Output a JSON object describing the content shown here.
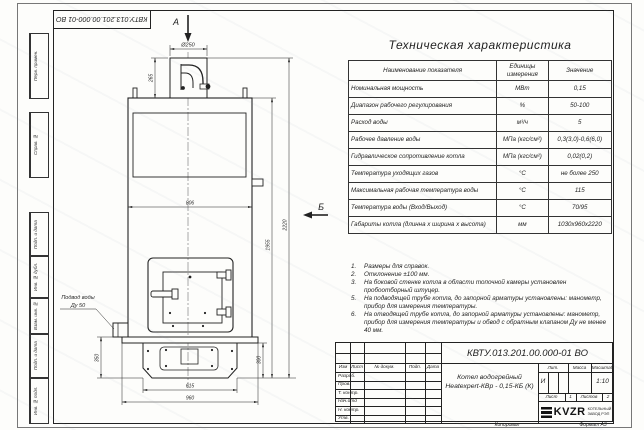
{
  "sheet": {
    "doc_number": "КВТУ.013.201.00.000-01 ВО",
    "copied_label": "Копировал",
    "format_label": "Формат А3",
    "margin_labels": [
      "Перв. примен.",
      "Справ. №",
      "Подп. и дата",
      "Инв. № дубл.",
      "Взам. инв. №",
      "Подп. и дата",
      "Инв. № подл."
    ]
  },
  "spec_table": {
    "title": "Техническая характеристика",
    "headers": [
      "Наименование показателя",
      "Единицы измерения",
      "Значение"
    ],
    "rows": [
      {
        "name": "Номинальная мощность",
        "unit": "МВт",
        "value": "0,15"
      },
      {
        "name": "Диапазон рабочего регулирования",
        "unit": "%",
        "value": "50-100"
      },
      {
        "name": "Расход воды",
        "unit": "м³/ч",
        "value": "5"
      },
      {
        "name": "Рабочее давление воды",
        "unit": "МПа (кгс/см²)",
        "value": "0,3(3,0)-0,6(6,0)"
      },
      {
        "name": "Гидравлическое сопротивление котла",
        "unit": "МПа (кгс/см²)",
        "value": "0,02(0,2)"
      },
      {
        "name": "Температура уходящих газов",
        "unit": "°С",
        "value": "не более 250"
      },
      {
        "name": "Максимальная рабочая температура воды",
        "unit": "°С",
        "value": "115"
      },
      {
        "name": "Температура воды (Вход/Выход)",
        "unit": "°С",
        "value": "70/95"
      },
      {
        "name": "Габариты котла (длинна х ширина х высота)",
        "unit": "мм",
        "value": "1030х960х2220"
      }
    ]
  },
  "notes": [
    {
      "num": "1.",
      "text": "Размеры для справок."
    },
    {
      "num": "2.",
      "text": "Отклонение ±100 мм."
    },
    {
      "num": "3.",
      "text": "На боковой стенке котла в области топочной камеры установлен пробоотборный штуцер."
    },
    {
      "num": "5.",
      "text": "На подводящей трубе котла, до запорной арматуры установлены: манометр, прибор для измерения температуры."
    },
    {
      "num": "6.",
      "text": "На отводящей трубе котла, до запорной арматуры установлены: манометр, прибор для измерения температуры и обвод с обратным клапаном Ду не менее 40 мм."
    }
  ],
  "title_block": {
    "columns": [
      "Изм",
      "Лист",
      "№ докум.",
      "Подп.",
      "Дата"
    ],
    "sign_rows": [
      "Разраб.",
      "Пров.",
      "Т. контр.",
      "Нач.отд",
      "Н. контр.",
      "Утв."
    ],
    "product_line1": "Котел водогрейный",
    "product_line2": "Heatexpert-КВр - 0,15-КБ (К)",
    "lit_header": "Лит.",
    "lit_value": "И",
    "mass_header": "Масса",
    "scale_header": "Масштаб",
    "scale_value": "1:10",
    "sheet_label": "Лист",
    "sheet_value": "1",
    "sheets_label": "Листов",
    "sheets_value": "2",
    "company_name": "KVZR",
    "company_line1": "КОТЕЛЬНЫЙ",
    "company_line2": "ЗАВОД РЭП"
  },
  "drawing": {
    "view_a_label": "А",
    "view_b_label": "Б",
    "water_inlet_line1": "Подвод воды",
    "water_inlet_line2": "Ду 50",
    "dims": {
      "chimney_diameter": "Ø250",
      "chimney_height": "265",
      "body_width": "806",
      "body_height": "1955",
      "total_height": "2220",
      "base_height_left": "350",
      "base_height_right": "300",
      "base_width_inner": "615",
      "base_width_outer": "960"
    }
  }
}
